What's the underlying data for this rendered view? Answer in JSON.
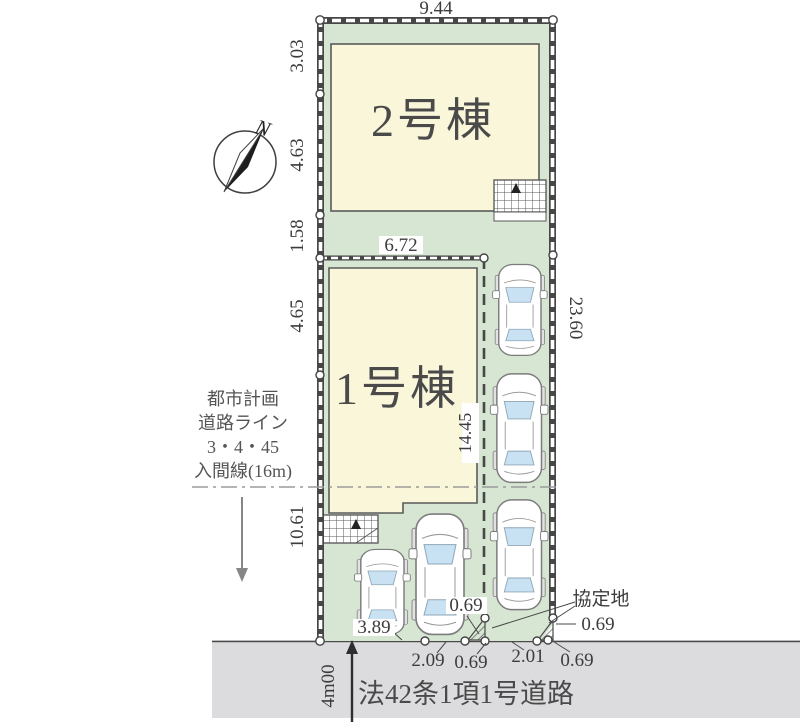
{
  "compass": {
    "north_label": "N"
  },
  "plot": {
    "dim_top": "9.44",
    "dims_left": [
      "3.03",
      "4.63",
      "1.58",
      "4.65",
      "10.61"
    ],
    "dim_lot1_width": "6.72",
    "dim_lot1_depth": "14.45",
    "dim_right": "23.60",
    "dim_bottom_left": "3.89",
    "dims_bottom": [
      "2.09",
      "0.69",
      "2.01",
      "0.69"
    ],
    "dim_setback_inner": "0.69",
    "dim_setback_right": "0.69",
    "agreement_label": "協定地",
    "buildings": [
      {
        "name": "2号棟"
      },
      {
        "name": "1号棟"
      }
    ]
  },
  "planning_note": {
    "lines": [
      "都市計画",
      "道路ライン",
      "3・4・45",
      "入間線(16m)"
    ]
  },
  "road": {
    "width_label": "4m00",
    "name": "法42条1項1号道路"
  },
  "colors": {
    "site_green": "#d6e6d2",
    "building_cream": "#faf6da",
    "road_gray": "#dcdcde",
    "boundary_dark": "#474747",
    "window_blue": "#c9e2f3",
    "text_dark": "#3c3c3c"
  }
}
